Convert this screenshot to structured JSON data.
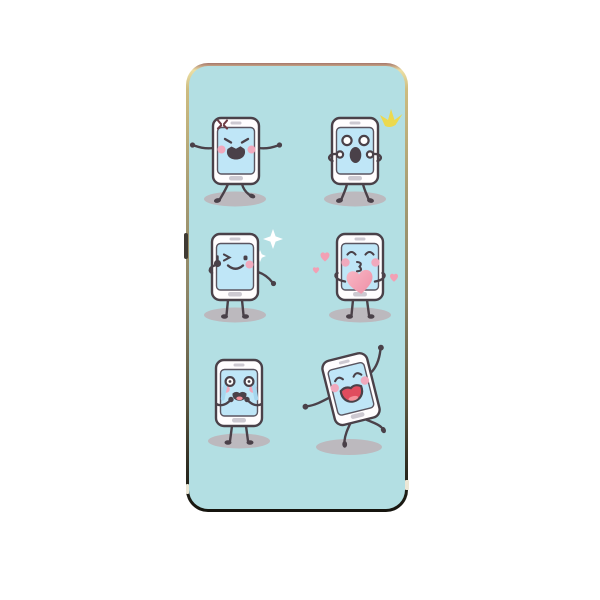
{
  "scene": {
    "type": "product-photo",
    "description": "Smartphone case printed with six cartoon smartphone characters showing different emotions on a teal background",
    "item": "phone case"
  },
  "case": {
    "label": "phone case with cartoon smartphone emoticons",
    "hardware": {
      "side_button": "side button",
      "antenna_notch_left": "antenna notch left",
      "antenna_notch_right": "antenna notch right"
    }
  },
  "characters": [
    {
      "id": "angry",
      "label": "angry phone stomping with arms out and anger mark",
      "accessory": "anger-mark"
    },
    {
      "id": "surprised",
      "label": "surprised phone with hands to face and yellow flash",
      "accessory": "yellow-flash"
    },
    {
      "id": "winking",
      "label": "winking phone giving thumbs up with white sparkles",
      "accessory": "white-sparkles"
    },
    {
      "id": "kissing",
      "label": "kissing phone holding a big heart with floating hearts",
      "accessory": "hearts"
    },
    {
      "id": "crying",
      "label": "crying phone with tears and hands to mouth",
      "accessory": "tears"
    },
    {
      "id": "laughing",
      "label": "laughing phone dancing with one arm raised",
      "accessory": "none"
    }
  ],
  "colors": {
    "page-bg": "#ffffff",
    "case-bg": "#b3dfe3",
    "outline": "#4a4149",
    "body": "#fffdfe",
    "screen": "#bfe6f7",
    "slot": "#cdc9d1",
    "cheek": "#f0a9bd",
    "shadow": "#bcb9be",
    "tear": "#a6d7ef",
    "heart": "#f2a0b4",
    "sparkle": "#ecd94e",
    "anger": "#6e3b44",
    "mouth-red": "#e04c5e",
    "tongue": "#f58f99",
    "frame-gold": "#cdbc80",
    "frame-dark": "#15140e"
  }
}
